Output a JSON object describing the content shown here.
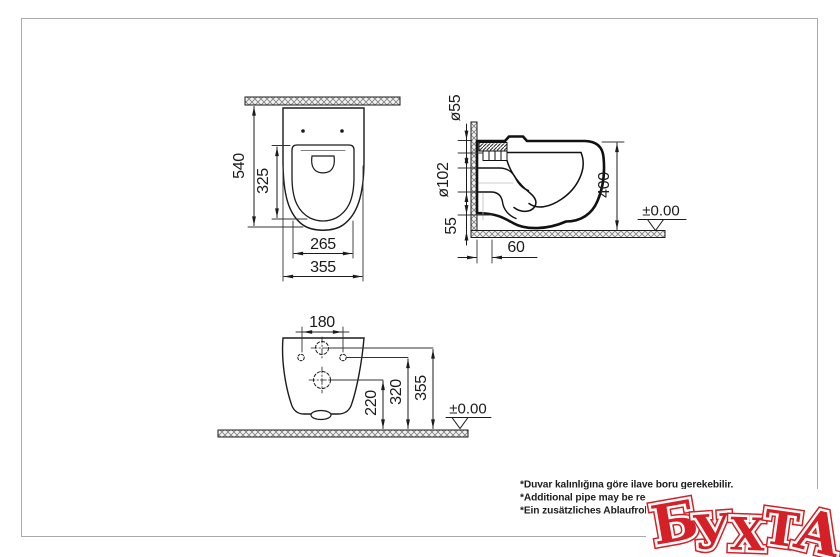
{
  "drawing": {
    "title": "wall-hung-toilet-installation-drawing",
    "line_color": "#1b1b1b",
    "frame_color": "#a9a9a9"
  },
  "top_view": {
    "overall_depth": "540",
    "seat_depth": "325",
    "seat_width": "265",
    "overall_width": "355"
  },
  "side_view": {
    "inlet_diameter": "ø55",
    "outlet_diameter": "ø102",
    "bottom_clearance": "55",
    "mounting_height": "400",
    "outlet_offset": "60",
    "level_mark": "±0.00"
  },
  "bottom_view": {
    "hole_spacing": "180",
    "outlet_center_height": "220",
    "hole_height": "320",
    "inlet_center_height": "355",
    "level_mark": "±0.00"
  },
  "footnotes": {
    "tr": "*Duvar kalınlığına göre ilave boru gerekebilir.",
    "en": "*Additional pipe may be required",
    "de": "*Ein zusätzliches Ablaufrohr ist j"
  },
  "watermark": {
    "text": "БУХТА",
    "color": "#d42026",
    "letters": [
      "Б",
      "У",
      "Х",
      "Т",
      "А"
    ]
  }
}
